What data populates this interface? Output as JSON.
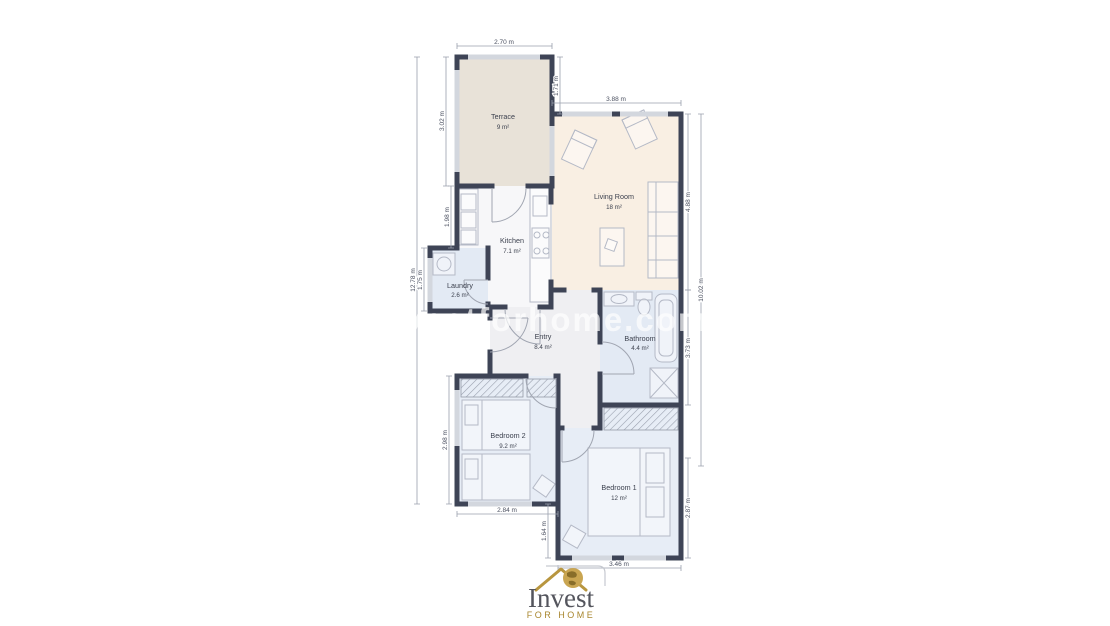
{
  "watermark": {
    "text": "investforhome.com"
  },
  "logo": {
    "brand": "Invest",
    "tagline": "FOR HOME"
  },
  "rooms": {
    "terrace": {
      "name": "Terrace",
      "area": "9 m²"
    },
    "living_room": {
      "name": "Living Room",
      "area": "18 m²"
    },
    "kitchen": {
      "name": "Kitchen",
      "area": "7.1 m²"
    },
    "laundry": {
      "name": "Laundry",
      "area": "2.6 m²"
    },
    "entry": {
      "name": "Entry",
      "area": "8.4 m²"
    },
    "bathroom": {
      "name": "Bathroom",
      "area": "4.4 m²"
    },
    "bedroom2": {
      "name": "Bedroom 2",
      "area": "9.2 m²"
    },
    "bedroom1": {
      "name": "Bedroom 1",
      "area": "12 m²"
    }
  },
  "dimensions": {
    "terrace_width": "2.70 m",
    "terrace_left": "3.02 m",
    "terrace_living_offset": "1.71 m",
    "living_width": "3.88 m",
    "living_right": "4.88 m",
    "overall_left": "12.78 m",
    "kitchen_left": "1.98 m",
    "laundry_left": "1.75 m",
    "bathroom_right": "3.73 m",
    "overall_right": "10.02 m",
    "bedroom2_left": "2.98 m",
    "bedroom2_width": "2.84 m",
    "bedroom1_offset_left": "1.64 m",
    "bedroom1_width": "3.46 m",
    "bedroom1_right": "2.87 m"
  },
  "colors": {
    "wall": "#3e4456",
    "terrace_fill": "#e8e2d8",
    "living_fill": "#f9efe3",
    "kitchen_fill": "#f7f7f9",
    "wet_room_fill": "#e3eaf4",
    "bedroom_fill": "#e7edf6",
    "entry_fill": "#efeff2",
    "dimension_line": "#9aa0ad",
    "logo_gold": "#b8963f",
    "logo_text": "#54555d",
    "watermark": "#ffffff"
  }
}
